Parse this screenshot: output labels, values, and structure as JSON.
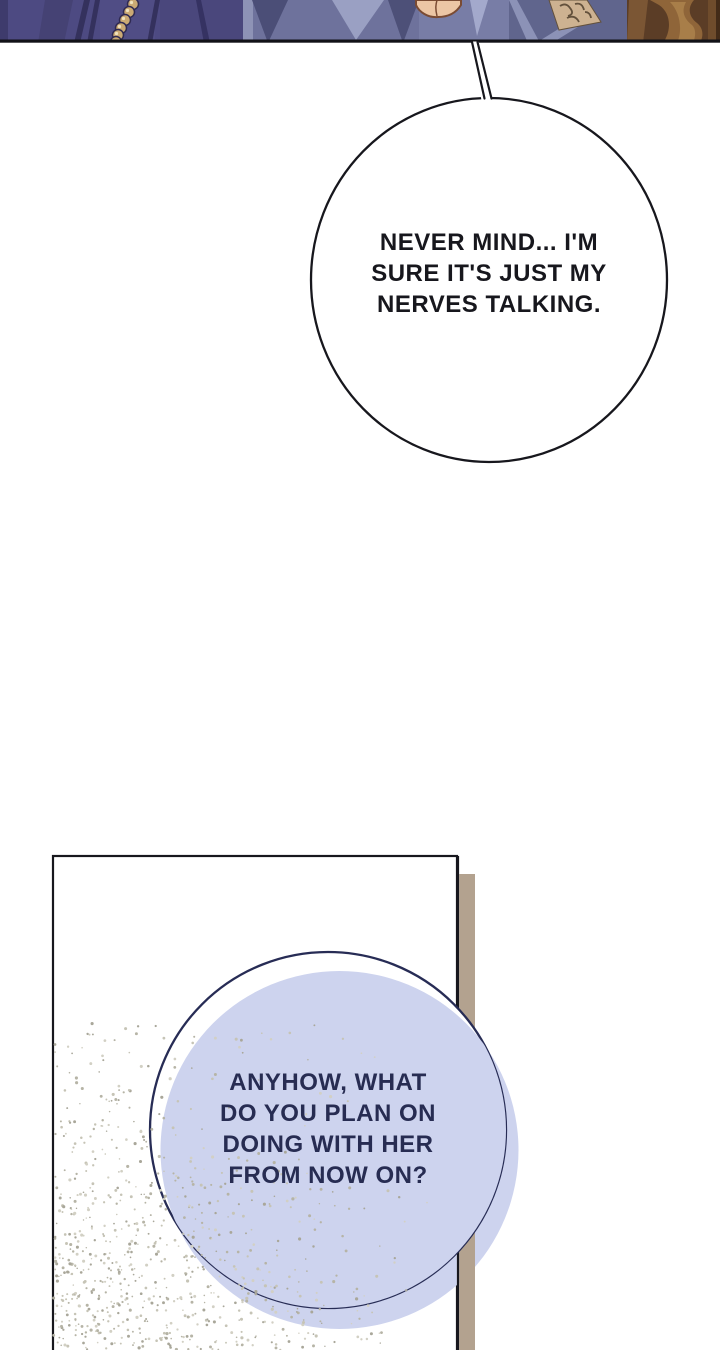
{
  "page": {
    "bg_color": "#ffffff"
  },
  "top_panel": {
    "border_color": "#121218",
    "palette": {
      "robe_dark_purple": "#4d4a82",
      "robe_purple_shadow": "#34315d",
      "robe_mid_blue": "#6e729c",
      "robe_light_blue": "#9aa0c3",
      "robe_steel_blue": "#60658d",
      "robe_steel_light": "#8c92b7",
      "skin": "#ecc6a5",
      "skin_outline": "#7a4b33",
      "beads_gold": "#cbaa74",
      "beads_outline": "#2f2a52",
      "embroidery_gold": "#cdb291",
      "embroidery_dark": "#63513c",
      "wood_dark": "#5b3d26",
      "wood_mid": "#8f6539",
      "wood_light": "#a87e49"
    }
  },
  "speech_bubble_1": {
    "lines": [
      "NEVER MIND... I'M",
      "SURE IT'S JUST MY",
      "NERVES TALKING."
    ],
    "fill_color": "#ffffff",
    "outline_color": "#17171d",
    "text_color": "#17171d"
  },
  "bottom_panel": {
    "bg_color": "#ffffff",
    "border_color": "#17171d",
    "shadow_color": "#b3a28f",
    "speckle_colors": [
      "#b6b4a6",
      "#c6c4b6",
      "#a9a79a",
      "#d2d0c4"
    ]
  },
  "speech_bubble_2": {
    "lines": [
      "ANYHOW, WHAT",
      "DO YOU PLAN ON",
      "DOING WITH HER",
      "FROM NOW ON?"
    ],
    "fill_color": "#cdd3ee",
    "outline_color": "#272c55",
    "text_color": "#272c52"
  }
}
